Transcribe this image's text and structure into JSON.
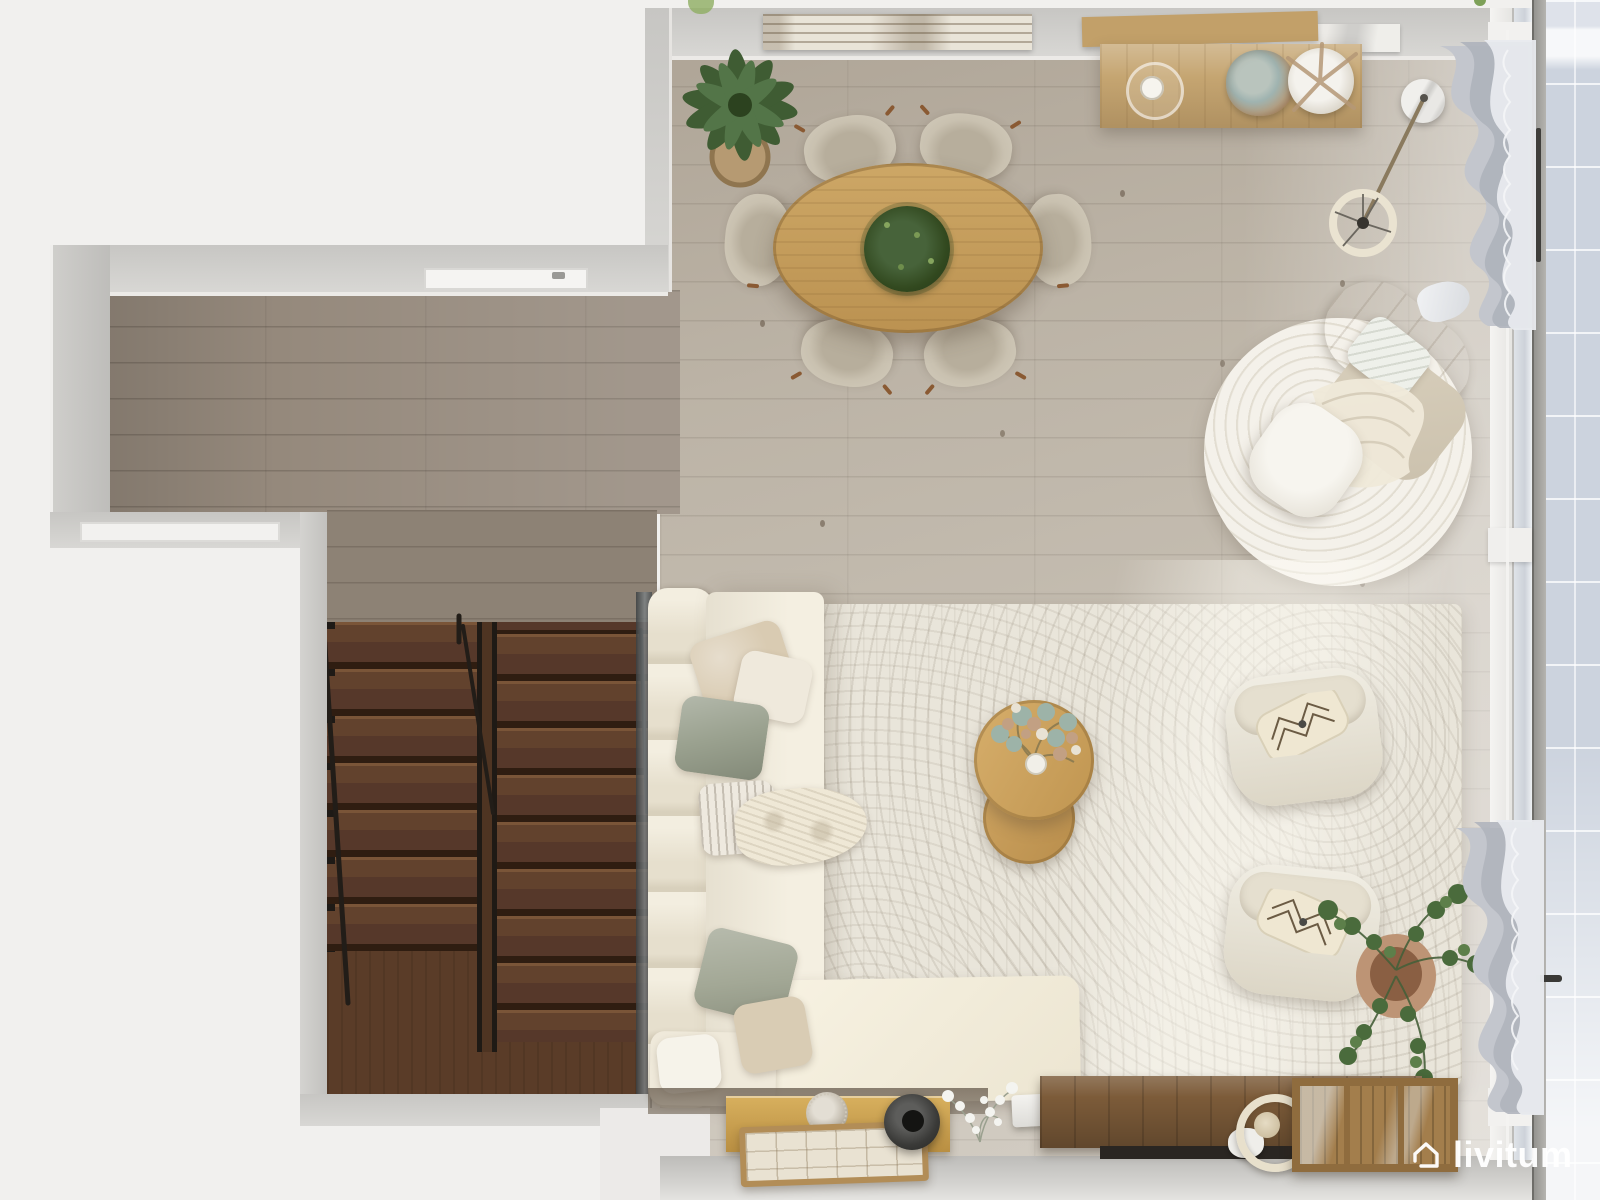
{
  "watermark": {
    "brand": "livitum",
    "icon": "house-outline-icon"
  },
  "palette": {
    "outside": "#f1f0ee",
    "wall": "#cbcac7",
    "floor_main": "#c2baad",
    "floor_hall": "#95897c",
    "stair_wood": "#5d4130",
    "sofa_cream": "#efe9da",
    "rug": "#e9e5da",
    "round_rug": "#f0ede4",
    "dining_wood": "#c49e5f",
    "walnut": "#7c5b39",
    "gold_cabinet": "#c59c4f",
    "balcony_tile": "#cdd3de",
    "plant_green": "#44603a",
    "curtain_gray": "#b6bac2"
  },
  "scene": {
    "type": "top-down 3D render of living-dining room",
    "rooms": [
      "hallway-with-staircase",
      "dining-area",
      "living-area",
      "balcony"
    ],
    "furniture": [
      "oval-dining-table",
      "dining-chairs-x6",
      "table-centerpiece-plant",
      "potted-plant",
      "wall-art-driftwood",
      "sideboard",
      "candle-hurricane",
      "dried-bouquet",
      "pampas-vase",
      "arc-floor-lamp",
      "round-rug",
      "reading-armchair",
      "ottoman",
      "area-rug",
      "l-shaped-sofa",
      "throw-pillows",
      "nesting-coffee-tables",
      "flower-bouquet",
      "accent-armchair-x2",
      "floor-plant",
      "gold-cabinet",
      "decor-ball",
      "wood-tray",
      "sphere-vase",
      "white-flowers",
      "projector",
      "media-console",
      "ring-lamp",
      "slatted-planter-box",
      "curtains",
      "sliding-window",
      "dark-wood-staircase"
    ]
  }
}
